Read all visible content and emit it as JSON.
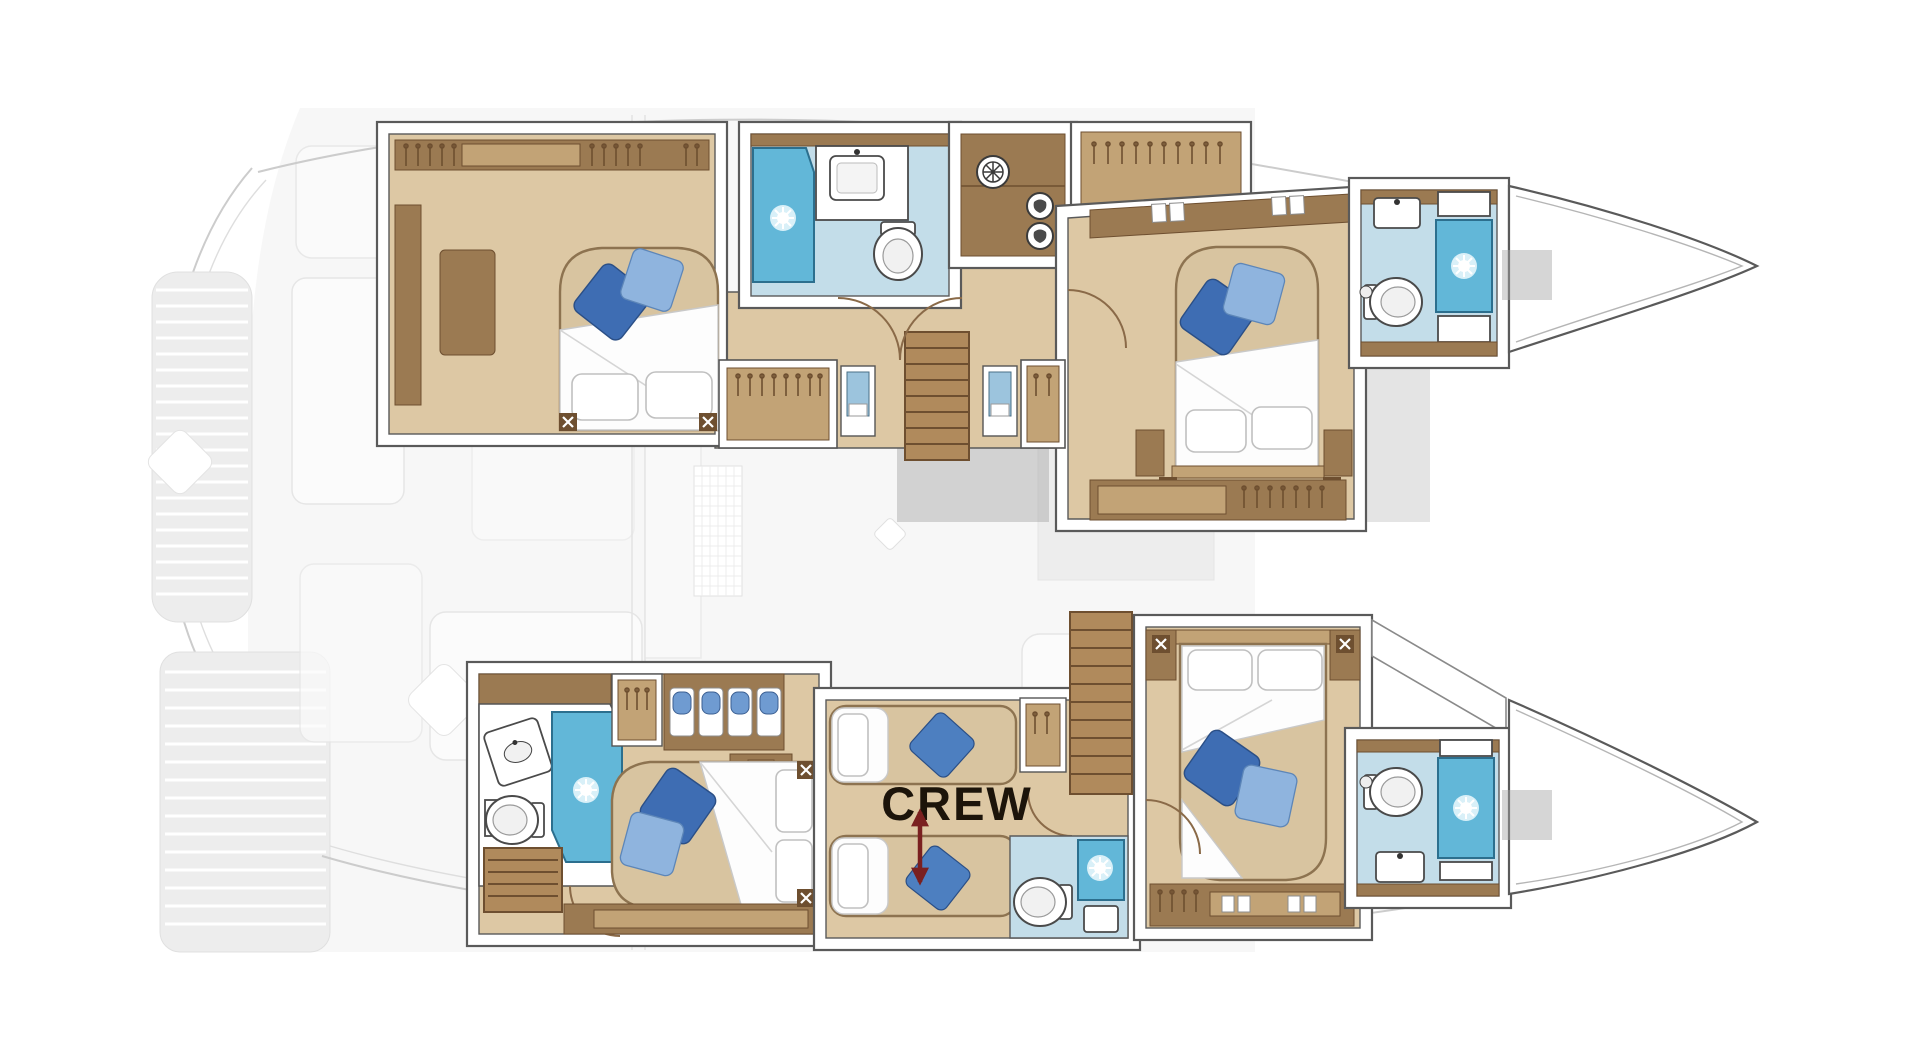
{
  "plan": {
    "labels": {
      "crew": "CREW"
    },
    "colors": {
      "wall-stroke": "#5a5a5a",
      "wood-floor": "#ddc8a4",
      "wood-mid": "#c2a376",
      "wood-dark": "#9b7a52",
      "wood-deep": "#6e4f30",
      "bath-floor": "#c3dde9",
      "shower-blue": "#62b7d8",
      "shower-deep": "#2c6f8e",
      "pillow-dark-blue": "#3e6db3",
      "pillow-mid-blue": "#4d7fc0",
      "pillow-light-blue": "#8fb4de",
      "bed-tan": "#d8c4a0",
      "bed-white": "#fdfdfd",
      "ghost-fill": "#f1f1f1",
      "ghost-stroke": "#cccccc",
      "ghost-dark": "#a5a5a5",
      "crew-text": "#1c140a",
      "crew-arrow": "#7a2020"
    }
  }
}
